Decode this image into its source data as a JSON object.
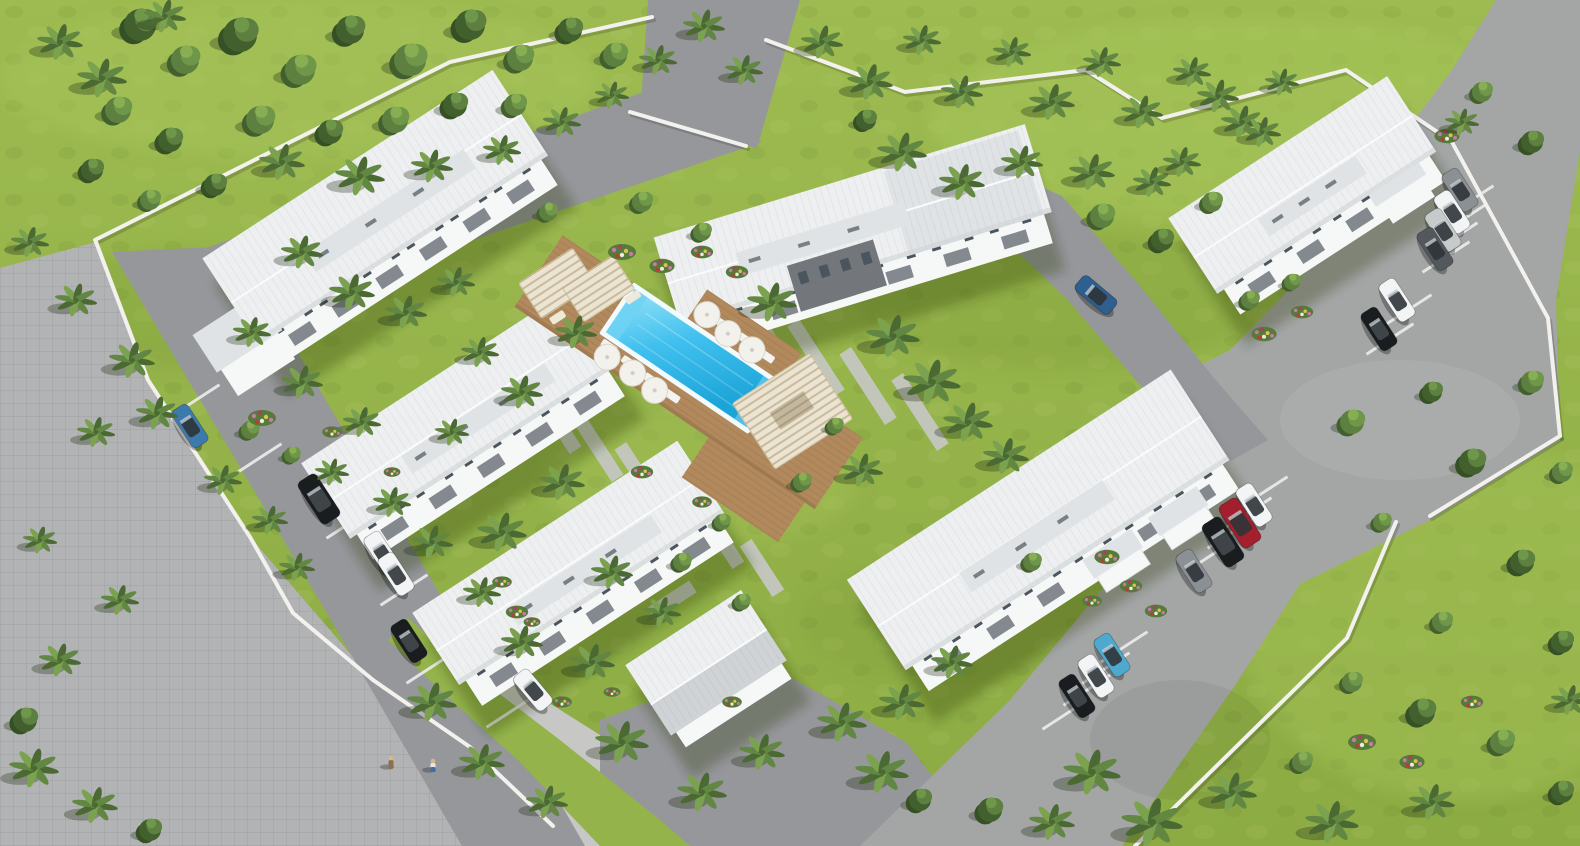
{
  "scene": {
    "title": "Aerial 3D architectural rendering of a tropical residential complex with central swimming pool",
    "setting": "Bird's-eye view of a gated community: six white two-storey apartment buildings and a small gabled outbuilding arranged around a central timber pool deck, surrounded by bright lawns, palm trees, internal asphalt driveways, a paved public road and low white perimeter walls",
    "buildings": [
      {
        "id": "building-northwest",
        "label": "Two-storey apartment building, north-west"
      },
      {
        "id": "building-north-center",
        "label": "Two-storey apartment building with grey accent facade, north-center"
      },
      {
        "id": "building-west-upper",
        "label": "Two-storey apartment building, west upper row"
      },
      {
        "id": "building-west-lower",
        "label": "Two-storey apartment building, west lower row"
      },
      {
        "id": "building-southeast",
        "label": "Two-storey apartment building beside angled parking, south-east"
      },
      {
        "id": "building-east",
        "label": "Two-storey apartment building beside parking lot, east"
      },
      {
        "id": "clubhouse",
        "label": "Small gabled outbuilding, south-center"
      }
    ],
    "amenities": {
      "pool": {
        "label": "Rectangular swimming pool",
        "color": "#40c0ee"
      },
      "deck": {
        "label": "Timber pool deck",
        "color": "#b1895c"
      },
      "pergolas": {
        "count": 3,
        "label": "Cream slatted pergola cabanas"
      },
      "umbrellas": {
        "count": 6,
        "label": "White parasols"
      },
      "sun_loungers": {
        "count": 12,
        "label": "White sun loungers"
      }
    },
    "vehicles": [
      {
        "name": "blue hatchback",
        "color": "#3c79ad",
        "kind": "car"
      },
      {
        "name": "black SUV",
        "color": "#1a1d20",
        "kind": "suv"
      },
      {
        "name": "white sedan",
        "color": "#f3f4f5",
        "kind": "car"
      },
      {
        "name": "white sedan",
        "color": "#f3f4f5",
        "kind": "car"
      },
      {
        "name": "black sedan",
        "color": "#1a1d20",
        "kind": "car"
      },
      {
        "name": "white sedan",
        "color": "#f3f4f5",
        "kind": "car"
      },
      {
        "name": "white sedan",
        "color": "#f3f4f5",
        "kind": "car"
      },
      {
        "name": "red SUV",
        "color": "#a31f2d",
        "kind": "suv"
      },
      {
        "name": "black SUV",
        "color": "#1a1d20",
        "kind": "suv"
      },
      {
        "name": "grey sedan",
        "color": "#8a9094",
        "kind": "car"
      },
      {
        "name": "teal-blue sedan",
        "color": "#4fa8cd",
        "kind": "car"
      },
      {
        "name": "white sedan",
        "color": "#f3f4f5",
        "kind": "car"
      },
      {
        "name": "black sedan",
        "color": "#1a1d20",
        "kind": "car"
      },
      {
        "name": "grey sedan",
        "color": "#8a9094",
        "kind": "car"
      },
      {
        "name": "white sedan",
        "color": "#f3f4f5",
        "kind": "car"
      },
      {
        "name": "silver sedan",
        "color": "#c6cacb",
        "kind": "car"
      },
      {
        "name": "dark-grey sedan",
        "color": "#53585c",
        "kind": "car"
      },
      {
        "name": "white sedan",
        "color": "#f3f4f5",
        "kind": "car"
      },
      {
        "name": "black sedan",
        "color": "#1a1d20",
        "kind": "car"
      },
      {
        "name": "dark-blue hatchback",
        "color": "#2e5f8f",
        "kind": "car"
      }
    ],
    "people": {
      "count": 2,
      "label": "Two pedestrians on the paved walkway"
    },
    "landscape": {
      "palm_trees": "about 70 palms",
      "shrubs": "about 45 shrubs and canopy trees",
      "flower_beds": "about 20 colourful flower beds",
      "lawn": "bright yellow-green grass",
      "perimeter": "low white boundary walls and curbs"
    }
  },
  "palette": {
    "grass": "#94b34a",
    "grassLight": "#a6c45a",
    "grassDark": "#7e9d3b",
    "forestDark": "#42602e",
    "bushA": "#5d8040",
    "bushB": "#6f9749",
    "bushC": "#88ae53",
    "bedGreen": "#567a39",
    "palmDark": "#4b6a33",
    "palmMid": "#628743",
    "palmLight": "#7ba34f",
    "flowerPink": "#c977ab",
    "flowerMagenta": "#a7415e",
    "flowerYellow": "#d6c552",
    "flowerWhite": "#ecece0",
    "flowerRed": "#b23f3a",
    "roadPaver": "#b2b3b4",
    "walkway": "#c7c7c5",
    "asphalt": "#96979a",
    "asphaltLight": "#a4a5a5",
    "parkLine": "#ebecec",
    "unitPath": "#c6c8c7",
    "curb": "#f2f1ed",
    "deck": "#b1895c",
    "deckShade": "#97744c",
    "poolDeep": "#1ba4d8",
    "poolMid": "#40c0ee",
    "poolLight": "#93e2f8",
    "poolStep": "#6fd2f3",
    "poolRim": "#f1fafd",
    "roofLight": "#edeff0",
    "roofMid": "#e0e3e5",
    "roofShade": "#cfd3d5",
    "roofRidge": "#fafbfc",
    "wall": "#f6f7f7",
    "wallShade": "#e1e4e5",
    "accentDark": "#73777b",
    "glass": "#4a555d",
    "porch": "#6f767c",
    "pergola": "#ece4d0",
    "pergolaLine": "#d2c6a9",
    "shadowBuilding": "rgba(30,42,18,0.28)",
    "shadowTree": "rgba(28,40,16,0.30)",
    "shadowHard": "rgba(0,0,0,0.30)",
    "carGlass": "#2d3439",
    "skin": "#d9b48c",
    "personBrown": "#8a6f52",
    "personBlue": "#3f6ea0"
  }
}
